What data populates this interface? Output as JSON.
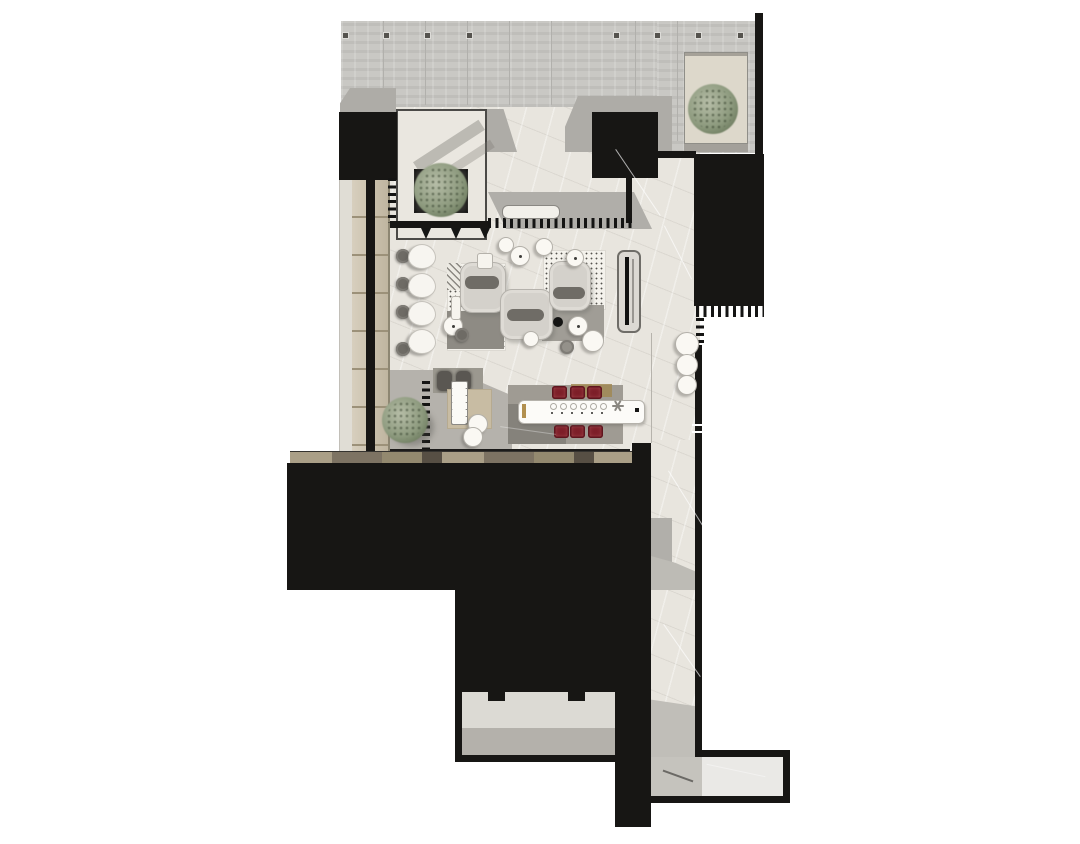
{
  "scene": {
    "kind": "architectural-floor-plan-render",
    "view": "top-down plan",
    "setting": "tea-house lounge and dining interior with entry court, corridor and rear exit",
    "visible_text": "none"
  },
  "palette": {
    "background": "#ffffff",
    "wall_black": "#171614",
    "concrete_wall": "#c9c8c4",
    "marble_floor": "#e8e5de",
    "shadow_gray": "#aeaca7",
    "wood_shelf": "#cabfa8",
    "deck_wood": "#8a7f6c",
    "sofa_gray": "#d4d1cb",
    "cushion_gray": "#6f6c66",
    "dining_chair_red": "#7d1f29",
    "accent_gold": "#a08853",
    "plant_green": "#8d9a7e",
    "rug_gray": "#9f9b93"
  },
  "rooms": [
    {
      "name": "entry-court",
      "feature": "concrete wall with anchor bolts, glass tea room with tree planter"
    },
    {
      "name": "main-lounge",
      "feature": "three curved sofas on dotted rugs, round tea tables, fireplace screen"
    },
    {
      "name": "reading-row",
      "feature": "four tulip chairs with round side tables along wood shelf wall"
    },
    {
      "name": "music-corner",
      "feature": "upright piano, two performer chairs, beige rug, two stools"
    },
    {
      "name": "dining-room",
      "feature": "long white table, six red chairs, gold screen bar, area rug"
    },
    {
      "name": "east-corridor",
      "feature": "marble gallery leading to rear exit"
    },
    {
      "name": "lower-room",
      "feature": "enclosed room with two door notches"
    },
    {
      "name": "terrace",
      "feature": "planter box with tree at north-east"
    }
  ],
  "furniture_inventory": {
    "sofas": 3,
    "sofa_cushions": 3,
    "round_tea_tables": 6,
    "small_stools": 5,
    "tulip_chairs": 4,
    "side_tables": 4,
    "dining_chairs_red": 6,
    "place_settings": 6,
    "benches": 1,
    "fireplace_screens": 1,
    "pianos": 1,
    "piano_stools": 2,
    "performer_chairs": 2,
    "corridor_stools": 3,
    "trees_plants": 3,
    "planters": 2
  },
  "symbols": {
    "comb_grille": "ventilation / curtain track tick pattern",
    "teeth_awning": "canopy edge with hanger teeth",
    "anchor_bolts": "formwork tie marks on concrete wall",
    "door_notches": "door frames of lower room"
  }
}
